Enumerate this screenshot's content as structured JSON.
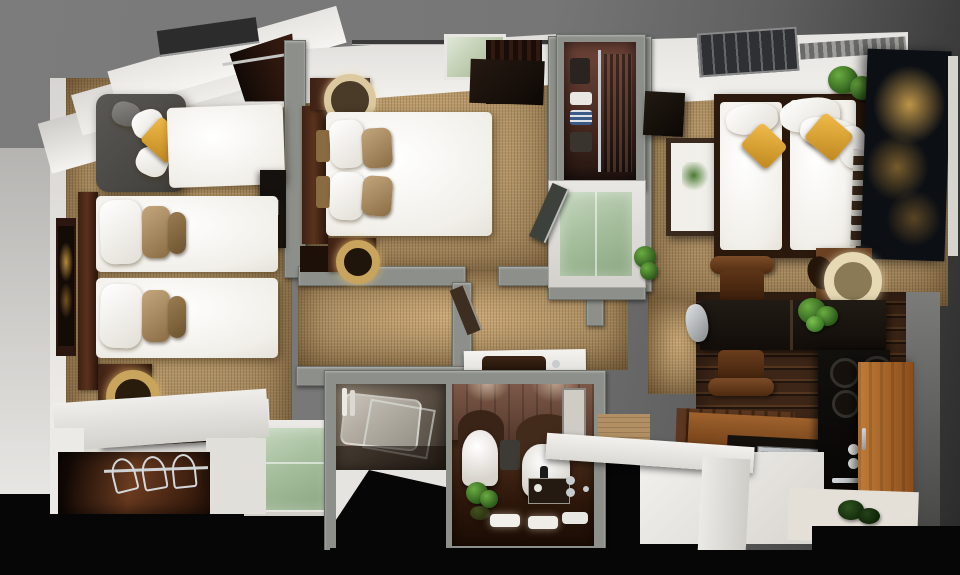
{
  "scene": {
    "description": "Photorealistic 3D cutaway floor plan of a hotel-style apartment, top-down dollhouse view",
    "rooms": [
      {
        "name": "bedroom-left",
        "furniture": [
          "corner-armchair",
          "chaise-daybed",
          "double-bed-1",
          "double-bed-2",
          "headboard-panel",
          "wall-artwork",
          "nightstand-gold-lamp",
          "luggage-bench",
          "open-closet-with-hangers",
          "green-glass-tub-panel",
          "skylight-window",
          "dark-curtain"
        ]
      },
      {
        "name": "bedroom-middle",
        "furniture": [
          "double-bed",
          "walnut-headboard",
          "dresser-round-mirror",
          "foot-nightstand-gold-lamp",
          "skylight-window",
          "curtain-rail",
          "dark-curtain-panel"
        ]
      },
      {
        "name": "wardrobe-corridor",
        "furniture": [
          "open-wardrobe-shelves",
          "folded-clothes",
          "hanging-garments",
          "walk-in-shower-green-glass",
          "shower-door",
          "potted-plant"
        ]
      },
      {
        "name": "hallway",
        "furniture": [
          "partition-walls",
          "door-leaf",
          "vanity-counter-dark-basin"
        ]
      },
      {
        "name": "bathroom",
        "furniture": [
          "bathtub",
          "glass-screen",
          "towel-rail",
          "toilet",
          "bidet-basin",
          "wall-mirror",
          "potted-plant",
          "vanity-tray",
          "towels",
          "door"
        ]
      },
      {
        "name": "living-room",
        "furniture": [
          "daybed-1",
          "daybed-2",
          "white-pillows",
          "yellow-cushions",
          "slatted-ladder",
          "city-photo-artwork",
          "botanical-artwork",
          "wall-speaker",
          "potted-plant",
          "side-table-cream-lamp",
          "black-desk",
          "kettle",
          "desk-plant",
          "wood-chair-1",
          "wood-chair-2",
          "skylight-window",
          "ceiling-vent"
        ]
      },
      {
        "name": "kitchen",
        "furniture": [
          "wood-bench",
          "dark-counter",
          "stainless-sink",
          "drainboard",
          "lower-wood-counter",
          "cooktop-burners",
          "oven-column",
          "tall-wood-cabinet",
          "floor-plant",
          "white-parapet-wall"
        ]
      }
    ],
    "palette": {
      "background_gray": "#7c7c7c",
      "background_dark_right": "#2b2b2b",
      "void_black": "#060606",
      "wall_top_gray": "#8d908a",
      "white_wall": "#f0efec",
      "carpet_tan": "#c19d6b",
      "walnut_dark": "#3c2114",
      "plank_floor": "#3d2617",
      "kitchen_cabinet": "#a86a30",
      "bedding_white": "#f1efe9",
      "pillow_tan": "#c3a67c",
      "cushion_yellow": "#e0a83c",
      "armchair_gray": "#4c4a46",
      "shower_glass_green": "#a7bf9e",
      "tub_glass_green": "#b9cfb2",
      "city_art_gold": "#d8aa50",
      "plant_green": "#3f7a2e",
      "steel": "#b9bcbe",
      "desk_black": "#191410"
    }
  }
}
